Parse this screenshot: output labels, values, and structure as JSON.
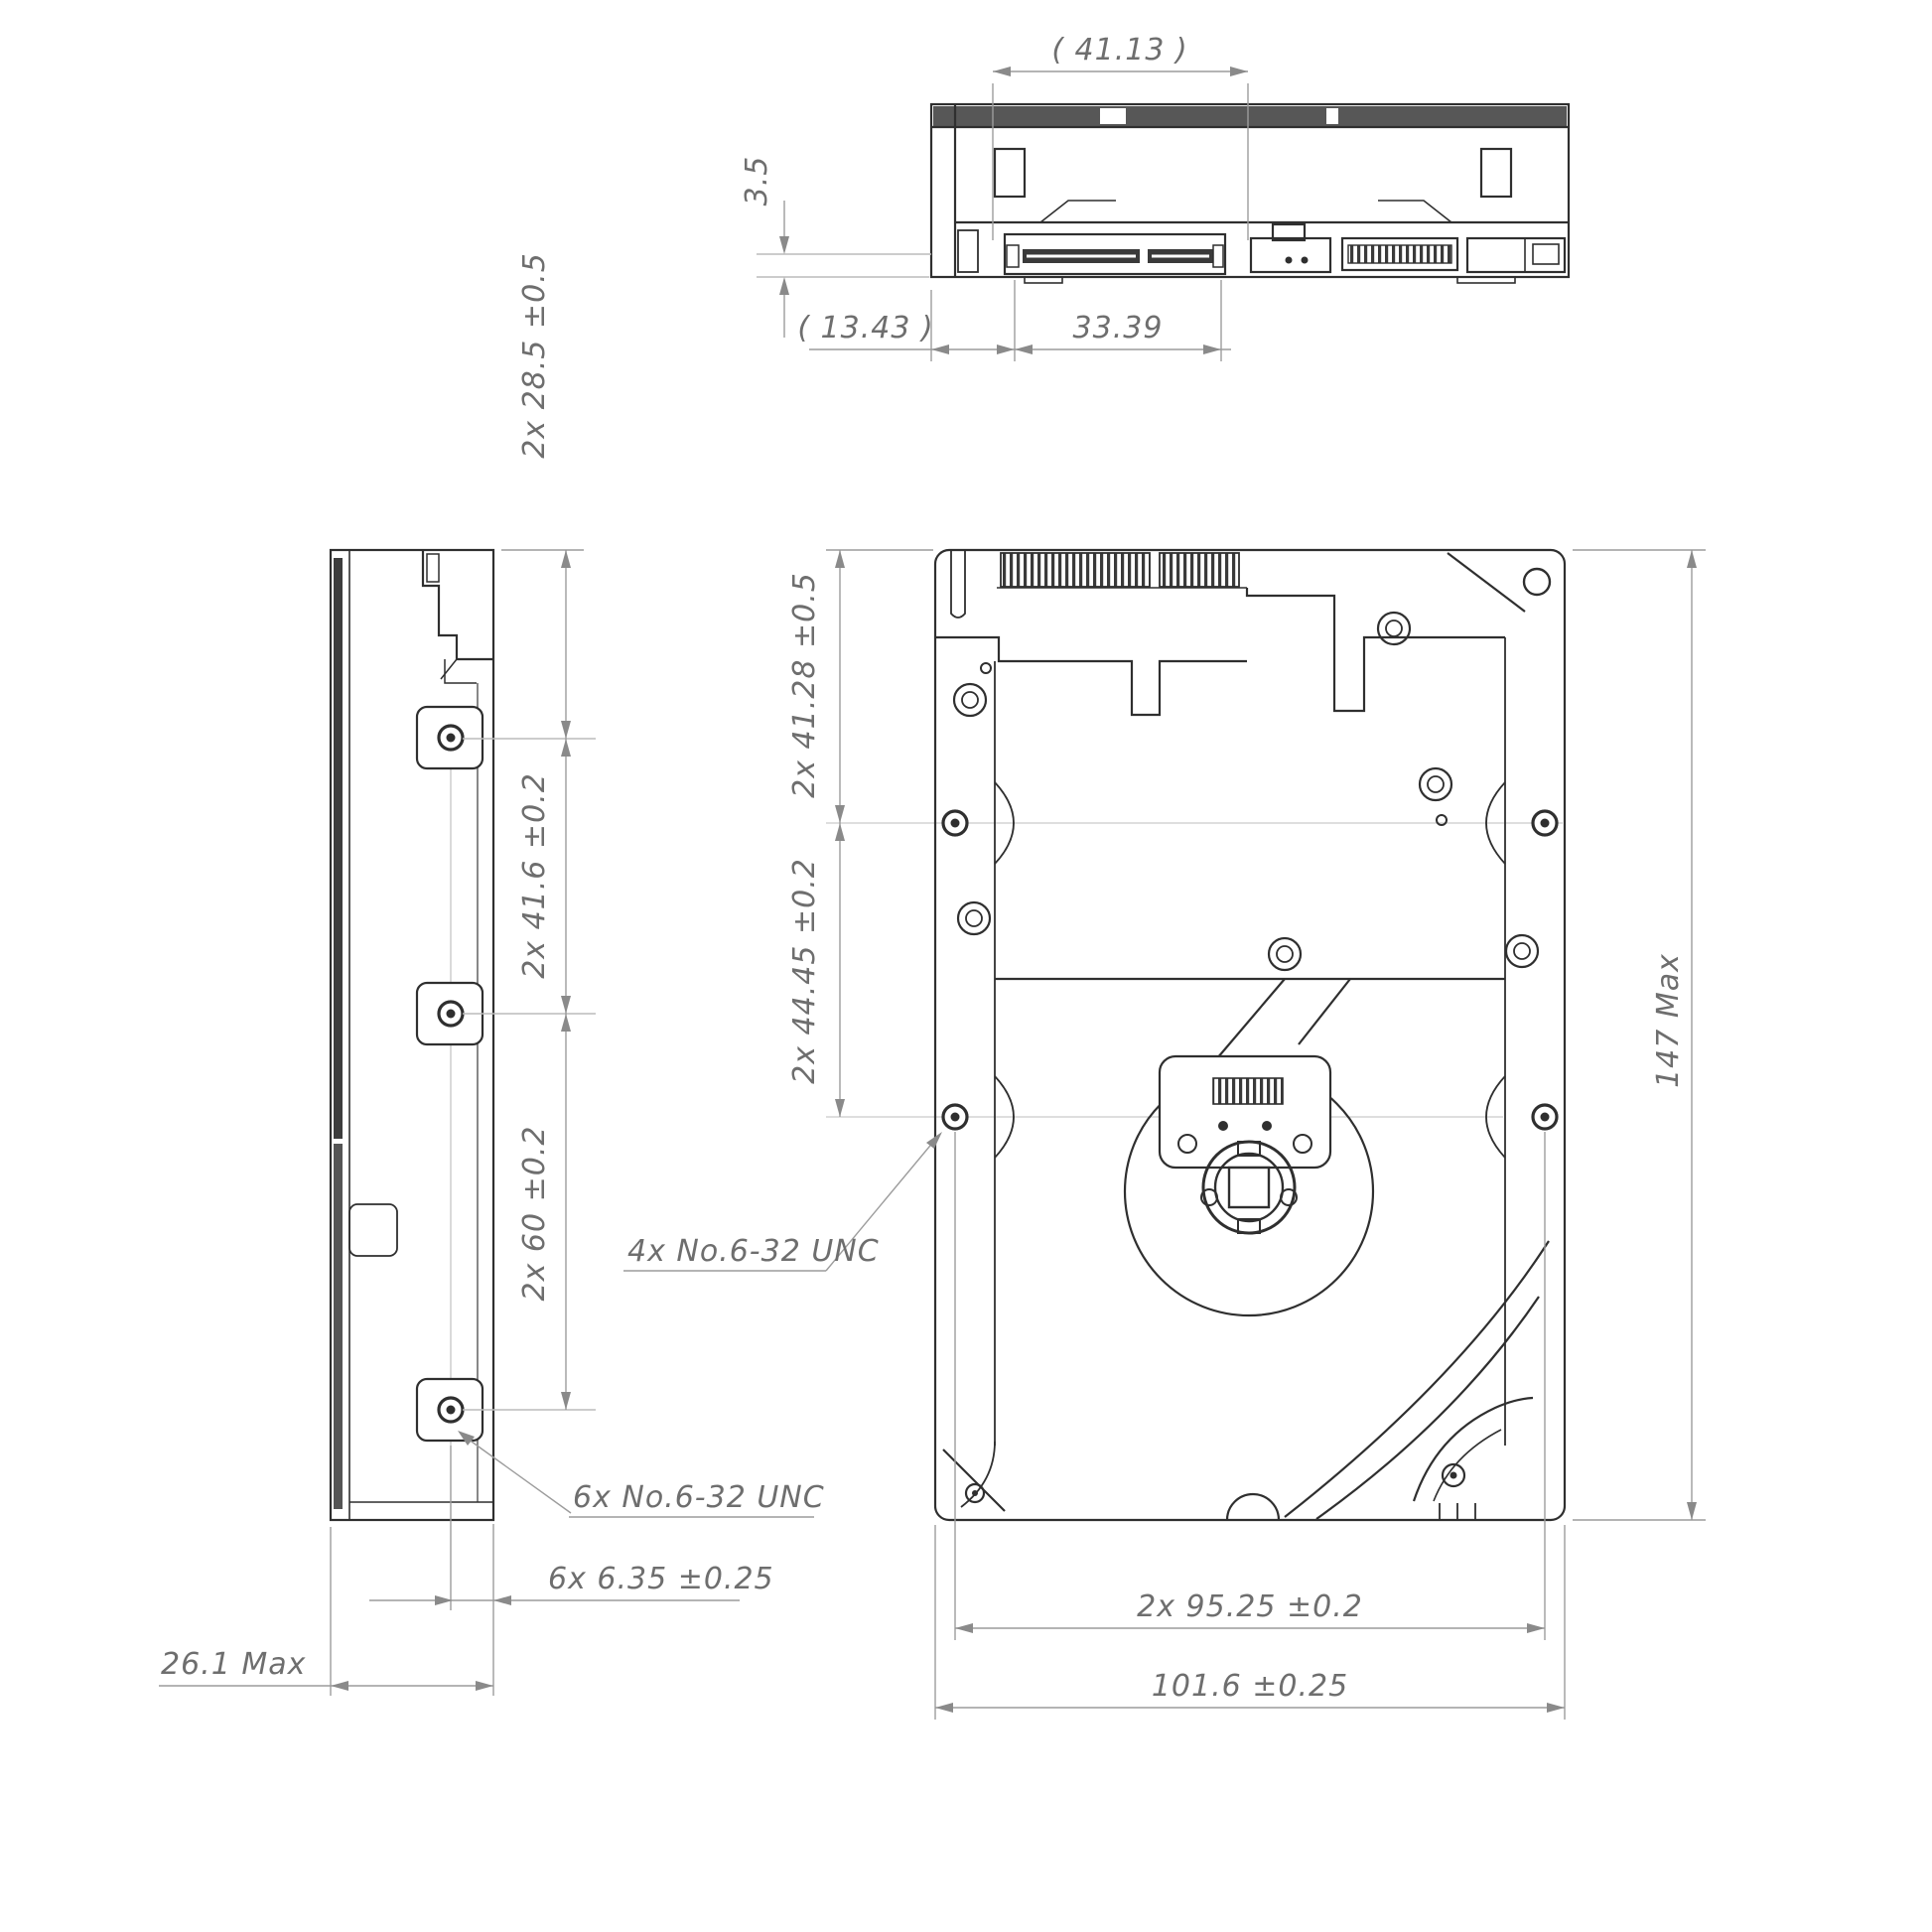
{
  "colors": {
    "background": "#ffffff",
    "object_line": "#2f2f2f",
    "dim_line": "#9c9c9c",
    "center_line": "#bcbcbc",
    "text": "#6e6e6e",
    "dark_fill": "#3a3a3a"
  },
  "views": {
    "rear_connector_view": {
      "labels": {
        "width_ref": "( 41.13 )",
        "connector_height": "3.5",
        "left_gap": "( 13.43 )",
        "connector_width": "33.39"
      }
    },
    "side_view": {
      "labels": {
        "end_to_first_hole": "2x 28.5 ±0.5",
        "hole_pitch_upper": "2x 41.6 ±0.2",
        "hole_pitch_lower": "2x 60 ±0.2",
        "side_thread_note": "6x No.6-32 UNC",
        "hole_offset": "6x 6.35 ±0.25",
        "drive_height": "26.1 Max"
      }
    },
    "bottom_view": {
      "labels": {
        "end_to_first_hole": "2x 41.28 ±0.5",
        "hole_pitch": "2x 44.45 ±0.2",
        "bottom_thread_note": "4x No.6-32 UNC",
        "hole_span": "2x 95.25 ±0.2",
        "drive_width": "101.6 ±0.25",
        "drive_length": "147 Max"
      }
    }
  }
}
